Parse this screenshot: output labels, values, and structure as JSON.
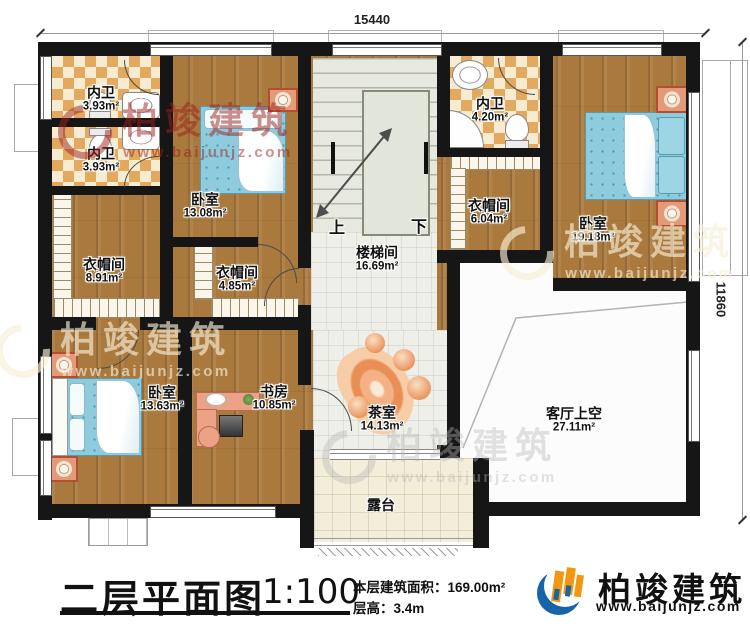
{
  "meta": {
    "title": "二层平面图",
    "scale": "1:100",
    "area_label": "本层建筑面积：",
    "area_value": "169.00m²",
    "height_label": "层高：",
    "height_value": "3.4m"
  },
  "dimensions": {
    "top": "15440",
    "right": "11860"
  },
  "brand": {
    "name": "柏竣建筑",
    "url": "www.baijunjz.com"
  },
  "watermark": {
    "name": "柏竣建筑",
    "url": "www.baijunjz.com"
  },
  "stairs": {
    "up": "上",
    "down": "下"
  },
  "rooms": {
    "bath1": {
      "name": "内卫",
      "area": "3.93m²"
    },
    "bath2": {
      "name": "内卫",
      "area": "3.93m²"
    },
    "bath3": {
      "name": "内卫",
      "area": "4.20m²"
    },
    "bedroom_top": {
      "name": "卧室",
      "area": "13.08m²"
    },
    "bedroom_right": {
      "name": "卧室",
      "area": "19.18m²"
    },
    "bedroom_bottom": {
      "name": "卧室",
      "area": "13.63m²"
    },
    "cloak_left": {
      "name": "衣帽间",
      "area": "8.91m²"
    },
    "cloak_mid": {
      "name": "衣帽间",
      "area": "4.85m²"
    },
    "cloak_right": {
      "name": "衣帽间",
      "area": "6.04m²"
    },
    "stair_hall": {
      "name": "楼梯间",
      "area": "16.69m²"
    },
    "study": {
      "name": "书房",
      "area": "10.85m²"
    },
    "tea": {
      "name": "茶室",
      "area": "14.13m²"
    },
    "terrace": {
      "name": "露台"
    },
    "void": {
      "name": "客厅上空",
      "area": "27.11m²"
    }
  }
}
